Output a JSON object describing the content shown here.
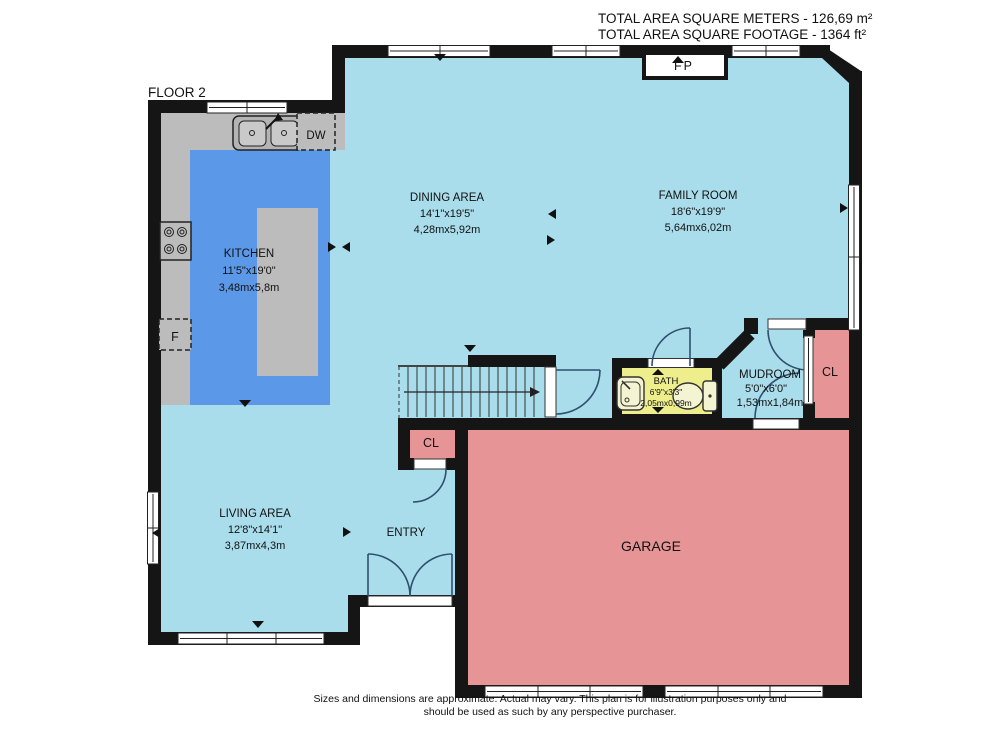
{
  "header": {
    "area_m2_label": "TOTAL AREA SQUARE METERS - 126,69 m²",
    "area_ft2_label": "TOTAL AREA SQUARE FOOTAGE - 1364 ft²",
    "floor_label": "FLOOR 2"
  },
  "rooms": {
    "kitchen": {
      "name": "KITCHEN",
      "dims_ft": "11'5\"x19'0\"",
      "dims_m": "3,48mx5,8m"
    },
    "dining_area": {
      "name": "DINING AREA",
      "dims_ft": "14'1\"x19'5\"",
      "dims_m": "4,28mx5,92m"
    },
    "family_room": {
      "name": "FAMILY ROOM",
      "dims_ft": "18'6\"x19'9\"",
      "dims_m": "5,64mx6,02m"
    },
    "living_area": {
      "name": "LIVING AREA",
      "dims_ft": "12'8\"x14'1\"",
      "dims_m": "3,87mx4,3m"
    },
    "bath": {
      "name": "BATH",
      "dims_ft": "6'9\"x3'3\"",
      "dims_m": "2,05mx0,99m"
    },
    "mudroom": {
      "name": "MUDROOM",
      "dims_ft": "5'0\"x6'0\"",
      "dims_m": "1,53mx1,84m"
    },
    "entry": {
      "name": "ENTRY"
    },
    "garage": {
      "name": "GARAGE"
    }
  },
  "fixtures": {
    "fireplace": "FP",
    "dishwasher": "DW",
    "fridge": "F",
    "closet": "CL"
  },
  "footer": {
    "disclaimer_line1": "Sizes and dimensions are approximate. Actual may vary. This plan is for illustration purposes only and",
    "disclaimer_line2": "should be used as such by any perspective purchaser."
  },
  "colors": {
    "floor": "#aaddec",
    "kitchen_floor": "#5b99e8",
    "counter": "#bcbcbc",
    "bath_floor": "#eeee8d",
    "garage_floor": "#e69495",
    "wall": "#151515"
  }
}
